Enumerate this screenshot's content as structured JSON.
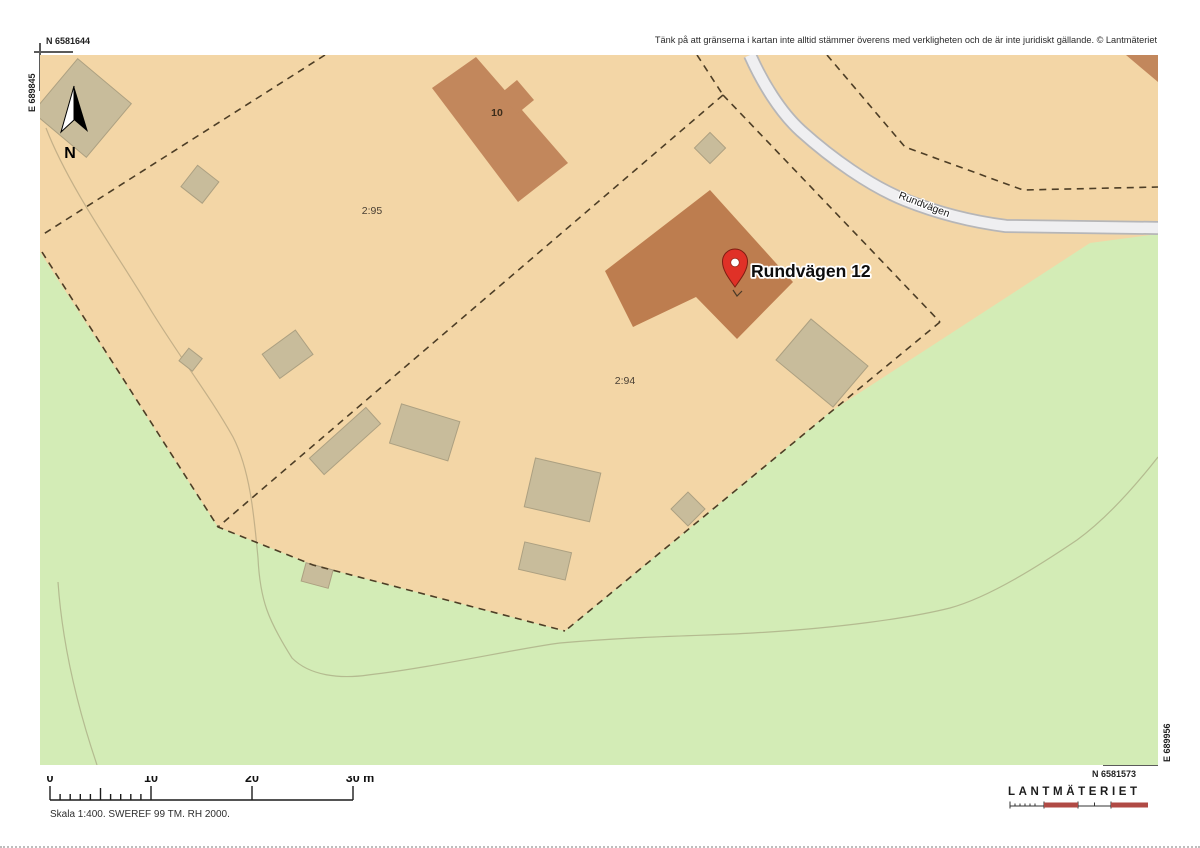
{
  "header": {
    "coord_n_topleft": "N 6581644",
    "disclaimer": "Tänk på att gränserna i kartan inte alltid stämmer överens med verkligheten och de är inte juridiskt gällande. © Lantmäteriet"
  },
  "frame": {
    "coord_e_left": "E 689845",
    "coord_n_bottomright": "N 6581573",
    "coord_e_right": "E 689956"
  },
  "map": {
    "north_label": "N",
    "parcel_295": "2:95",
    "parcel_294": "2:94",
    "building_10": "10",
    "road_name": "Rundvägen",
    "pin_label": "Rundvägen 12"
  },
  "scalebar": {
    "ticks": [
      "0",
      "10",
      "20",
      "30 m"
    ],
    "caption": "Skala 1:400. SWEREF 99 TM. RH 2000."
  },
  "logo": {
    "text": "LANTMÄTERIET"
  },
  "colors": {
    "parcel_tan": "#f3d6a6",
    "nature_green": "#d3ecb6",
    "house_brown": "#bd7d4f",
    "outbuilding_tan": "#c8bc9b",
    "road_fill": "#efeff1",
    "road_casing": "#b6b6b8",
    "boundary_dash": "#4d3e26",
    "pin_red": "#e03127",
    "logo_red": "#b04a45"
  }
}
